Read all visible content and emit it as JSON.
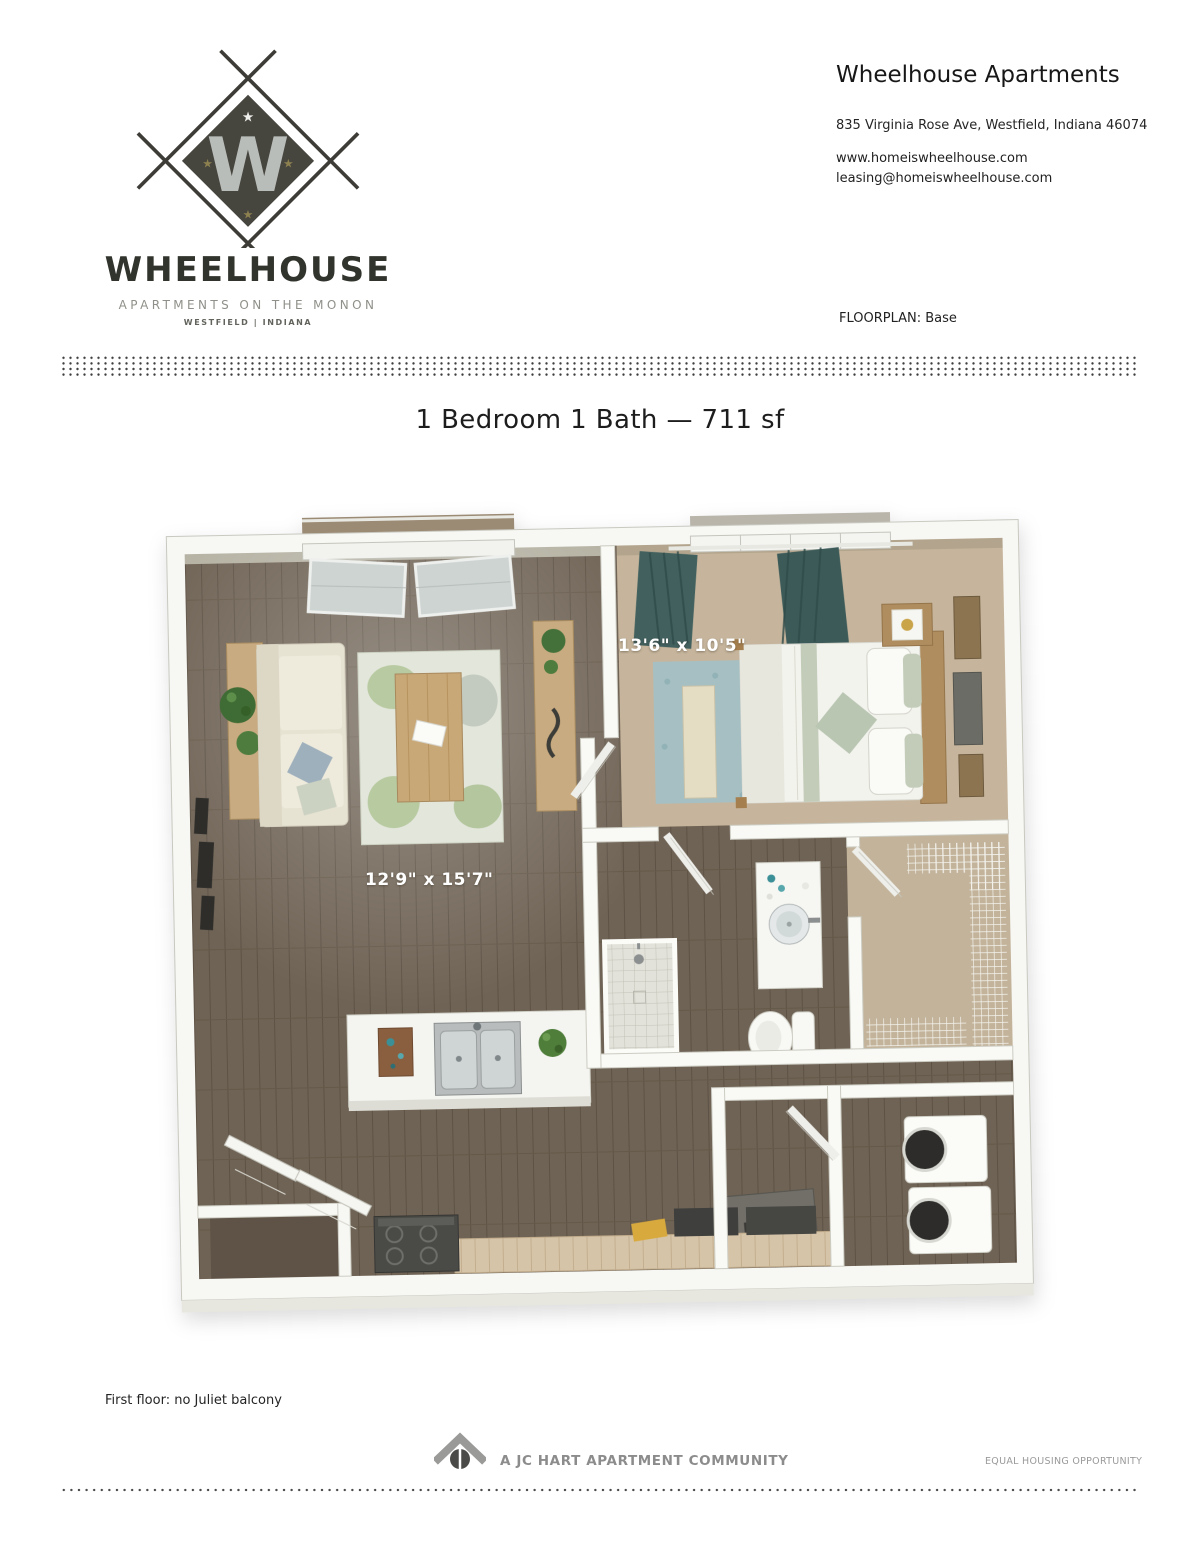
{
  "header": {
    "logo": {
      "monogram": "W",
      "brand": "WHEELHOUSE",
      "tagline": "APARTMENTS ON THE MONON",
      "location": "WESTFIELD | INDIANA"
    },
    "company": "Wheelhouse Apartments",
    "address": "835 Virginia Rose Ave, Westfield, Indiana 46074",
    "website": "www.homeiswheelhouse.com",
    "email": "leasing@homeiswheelhouse.com",
    "floorplan_label": "FLOORPLAN: Base"
  },
  "plan": {
    "title": "1 Bedroom 1 Bath — 711 sf",
    "bedroom_dimensions": "13'6\" x 10'5\"",
    "living_dimensions": "12'9\" x 15'7\"",
    "mech_label": "MECH",
    "note": "First floor: no Juliet balcony"
  },
  "footer": {
    "community": "A JC HART APARTMENT COMMUNITY",
    "equal_housing": "EQUAL HOUSING OPPORTUNITY"
  },
  "colors": {
    "wood_floor": "#6f6355",
    "carpet": "#c6b59c",
    "walls": "#f7f7f3",
    "curtains": "#41605e",
    "bedroom_rug": "#a6bfc2",
    "living_rug": "#e3e6db",
    "accent_wood": "#c8ab80",
    "logo_dark": "#46453e",
    "footer_gray": "#8c8c8c"
  }
}
